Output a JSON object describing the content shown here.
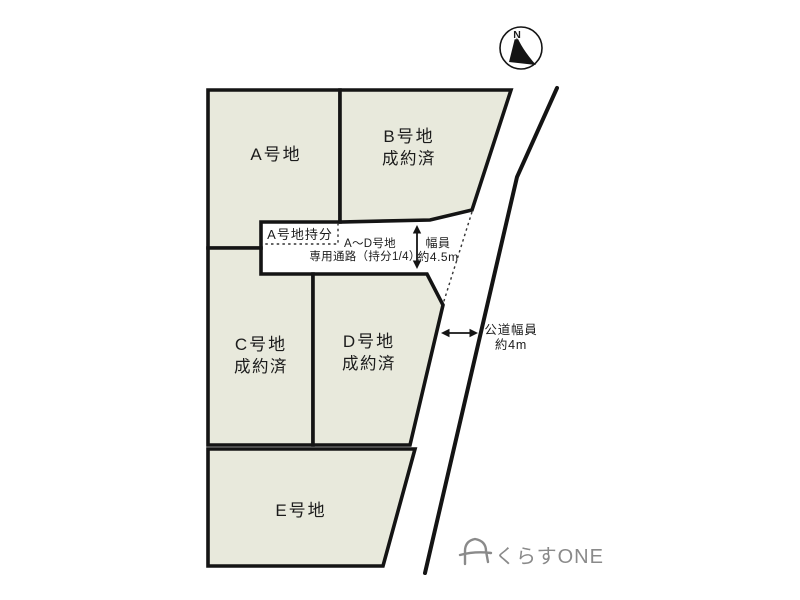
{
  "colors": {
    "lot_fill": "#e8e9dc",
    "line": "#141414",
    "logo_gray": "#8a8a8a",
    "background": "#ffffff"
  },
  "compass": {
    "north_label": "N"
  },
  "lots": {
    "a": {
      "label": "A号地"
    },
    "b": {
      "label": "B号地",
      "status": "成約済"
    },
    "c": {
      "label": "C号地",
      "status": "成約済"
    },
    "d": {
      "label": "D号地",
      "status": "成約済"
    },
    "e": {
      "label": "E号地"
    }
  },
  "private_road": {
    "share_label": "A号地持分",
    "passage_line1": "A～D号地",
    "passage_line2": "専用通路（持分1/4）",
    "width_line1": "幅員",
    "width_line2": "約4.5m"
  },
  "public_road": {
    "width_line1": "公道幅員",
    "width_line2": "約4m"
  },
  "logo": {
    "text": "くらすONE"
  }
}
